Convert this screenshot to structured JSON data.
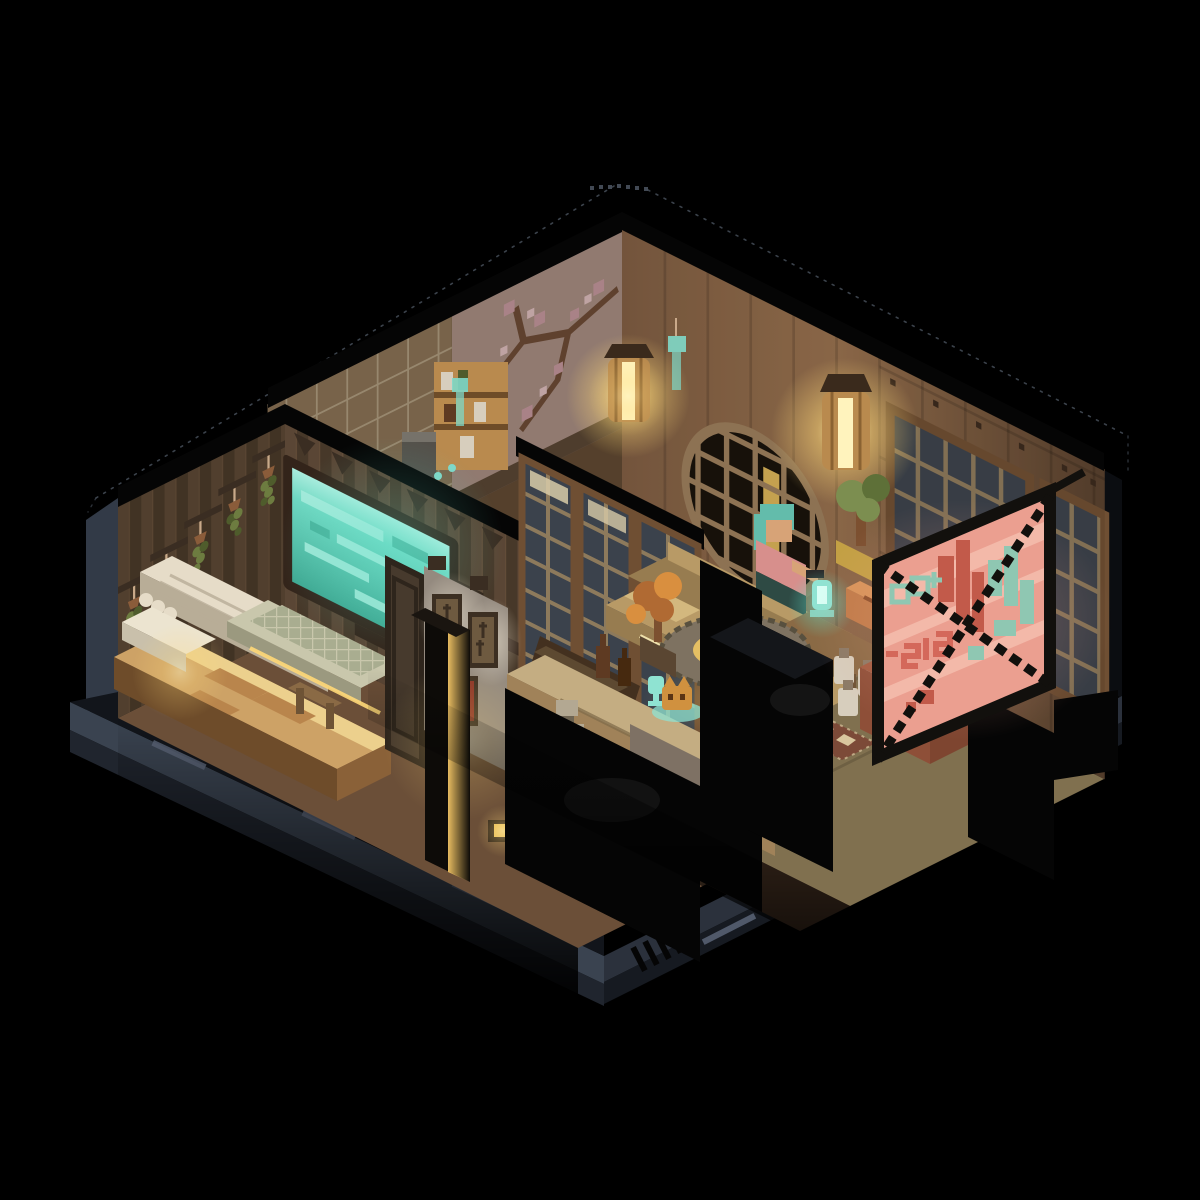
{
  "scene": {
    "type": "voxel-isometric-render",
    "setting": "Isometric voxel cutaway of a Japanese apartment at night",
    "sign_text": "515"
  },
  "objects": [
    {
      "name": "bedroom",
      "items": [
        "striped-wallpaper",
        "hanging-plants",
        "teal-screen",
        "keyboard-desk",
        "bed",
        "pillow",
        "curtain-canopy"
      ]
    },
    {
      "name": "pantry-room",
      "items": [
        "tile-wall",
        "cherry-blossom-mural",
        "shelf-unit",
        "appliance",
        "wind-chime"
      ]
    },
    {
      "name": "hallway",
      "items": [
        "shoji-doors",
        "framed-art",
        "spotlights",
        "glowing-pillar",
        "stairs",
        "door-slab"
      ]
    },
    {
      "name": "living-room",
      "items": [
        "round-lattice-window",
        "shoji-window",
        "hanging-lantern",
        "bonsai",
        "couch",
        "character",
        "side-table",
        "teal-lamp",
        "round-glowing-table",
        "autumn-plant",
        "sake-jars",
        "entry-rug"
      ]
    },
    {
      "name": "kitchen",
      "items": [
        "counter",
        "bottles",
        "teal-goblets",
        "cat-figurine",
        "steel-pan",
        "steel-pot",
        "robot-figure"
      ]
    },
    {
      "name": "exterior",
      "items": [
        "neon-sign",
        "platform-base",
        "roof-wireframe"
      ]
    }
  ],
  "palette": {
    "bg": "#000000",
    "black": "#050505",
    "platform_face": "#3a4350",
    "platform_face_dark": "#20252e",
    "platform_right": "#2b313c",
    "platform_right_dark": "#161a21",
    "platform_dash": "#5b6578",
    "exterior_left": "#323a47",
    "exterior_right": "#0b0d11",
    "wire_dot": "#4a525e",
    "wall_warm_light": "#96704e",
    "wall_warm": "#7d5c42",
    "wall_warm_dark": "#57402e",
    "wall_stud": "#3a2a1e",
    "mural_wall": "#ab9288",
    "mural_branch": "#6e4c38",
    "mural_blossom": "#c99ca4",
    "mural_blossom_light": "#e3c4c6",
    "tile_wall": "#8d7659",
    "tile_grout": "#b3a285",
    "stripe_a": "#66513d",
    "stripe_b": "#50402f",
    "stripe_trim": "#3a2d22",
    "plant_green": "#6d7c40",
    "plant_green_dark": "#4f5c2c",
    "plant_pot": "#8a5c3a",
    "plant_string": "#c9aa8a",
    "screen_teal": "#6fd8c2",
    "screen_teal_light": "#a9ecdd",
    "screen_frame": "#33241a",
    "keyboard_base": "#c9c7ac",
    "keyboard_keys": "#a9ad90",
    "keyboard_side": "#9b997f",
    "curtain": "#e6dcc8",
    "curtain_shadow": "#b8ad97",
    "bed_blanket": "#cda266",
    "bed_blanket_light": "#ecd08d",
    "bed_step": "#b9854c",
    "bed_wood": "#8a6138",
    "bed_pillow": "#ece4d0",
    "floor_hall": "#6b4f38",
    "floor_hall_dark": "#43301f",
    "floor_pantry": "#55402c",
    "floor_tatami": "#80704f",
    "floor_wood_front": "#5a3f2c",
    "stair": "#3e3122",
    "stair_lit": "#5d4931",
    "door_dark": "#473a2d",
    "door_frame": "#2e251c",
    "art_wall": "#948a7f",
    "art_wall_lit": "#b5aa9c",
    "frame_dark": "#3c2f22",
    "frame_fill": "#6e5a40",
    "frame_red": "#8a3326",
    "shoji_frame": "#6f4f33",
    "shoji_pane": "#3b424c",
    "shoji_lit": "#d8cba8",
    "shoji_grid": "#8d7a5c",
    "lattice_ring": "#9a7d5c",
    "lattice_dark": "#17110b",
    "lit_pane_gold": "#e8c05e",
    "lantern_glow": "#ffd978",
    "lantern_core": "#fff3bd",
    "lantern_wood": "#b98a4e",
    "lantern_slat": "#8a6232",
    "lantern_cap": "#3a2a1c",
    "chime_teal": "#7fd8c8",
    "pillar_glow": "#f2c464",
    "pillar_dark": "#0d0b08",
    "couch": "#b89a66",
    "couch_dark": "#977c50",
    "couch_light": "#d3b87e",
    "char_hair": "#63bcab",
    "char_skin": "#d7a377",
    "char_shirt": "#d78f8c",
    "char_dark": "#2e4a44",
    "bonsai_leaf": "#7c8e50",
    "bonsai_leaf_dark": "#5e7038",
    "bonsai_trunk": "#7c5030",
    "bonsai_pot": "#c3a044",
    "table_top": "#7e7261",
    "table_glow_ring": "#e5bf63",
    "table_glow_core": "#f8ecae",
    "table_leg": "#4a3a28",
    "side_table": "#8a6a45",
    "side_table_dark": "#6e5335",
    "lamp_teal": "#8fe3d2",
    "box_orange": "#c07b48",
    "autumn_leaf": "#b06a33",
    "autumn_leaf_light": "#d98f3f",
    "autumn_pot": "#5a4632",
    "counter_top": "#c4ad82",
    "counter_front": "#a08259",
    "counter_low": "#7e7164",
    "bottle_amber": "#5e3a22",
    "goblet_teal": "#8fe3d2",
    "cat_orange": "#d0913f",
    "pan_steel": "#7e8a96",
    "pot_steel": "#9aa2aa",
    "robot_bone": "#b3a892",
    "robot_dark": "#6e6452",
    "jar_white": "#d7cebd",
    "jar_cap": "#8a7a66",
    "rug_base": "#7c4a38",
    "rug_motif": "#d9c69e",
    "terracotta_top": "#a35c41",
    "terracotta_front": "#7e4530",
    "terracotta_side": "#8e4f38",
    "sign_frame": "#12100d",
    "sign_pink": "#eb9f90",
    "sign_pink_light": "#f5beae",
    "sign_red": "#c25a4a",
    "sign_teal": "#8fc7b2",
    "sign_glyph": "#d4685a",
    "glow_warm": "#ffcf7a",
    "glow_teal": "#63e6cf",
    "glow_pink": "#f0a08e",
    "highlight_soft": "#2b2b2b"
  }
}
